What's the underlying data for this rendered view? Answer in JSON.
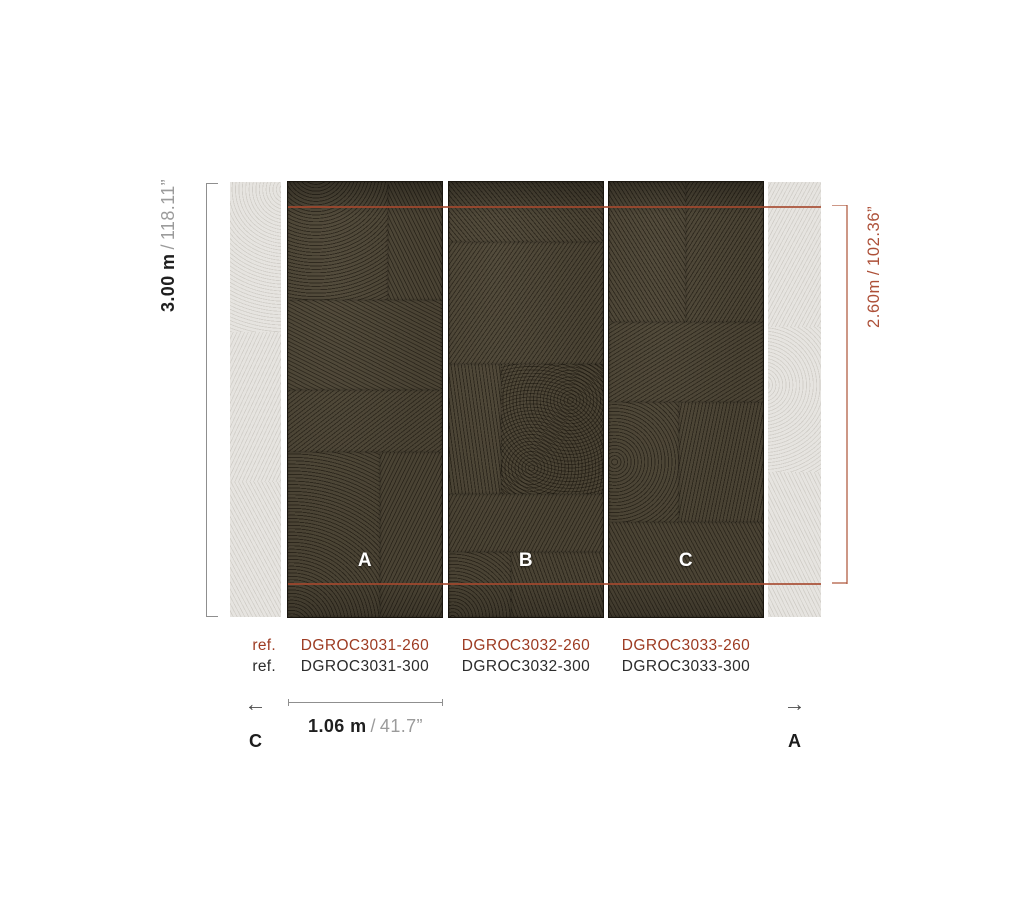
{
  "diagram": {
    "dimensions": {
      "height_full": {
        "metric": "3.00 m",
        "separator": "/",
        "imperial": "118.11”"
      },
      "height_partial": {
        "metric": "2.60m",
        "separator": "/",
        "imperial": "102.36”"
      },
      "panel_width": {
        "metric": "1.06 m",
        "separator": "/",
        "imperial": "41.7”"
      }
    },
    "panels": [
      {
        "label": "A",
        "ref_260": "DGROC3031-260",
        "ref_300": "DGROC3031-300"
      },
      {
        "label": "B",
        "ref_260": "DGROC3032-260",
        "ref_300": "DGROC3032-300"
      },
      {
        "label": "C",
        "ref_260": "DGROC3033-260",
        "ref_300": "DGROC3033-300"
      }
    ],
    "edge_panels": {
      "left": {
        "label": "C",
        "arrow_icon": "←"
      },
      "right": {
        "label": "A",
        "arrow_icon": "→"
      }
    },
    "ref_rows": {
      "row_260_label": "ref.",
      "row_300_label": "ref."
    },
    "colors": {
      "accent_red": "#a6492e",
      "ref_code_red": "#9d3b22",
      "dimension_gray": "#8f8f8f",
      "panel_dark": "#4a4334",
      "panel_light": "#e6e4e0",
      "text_dark": "#1f1f1f"
    }
  }
}
